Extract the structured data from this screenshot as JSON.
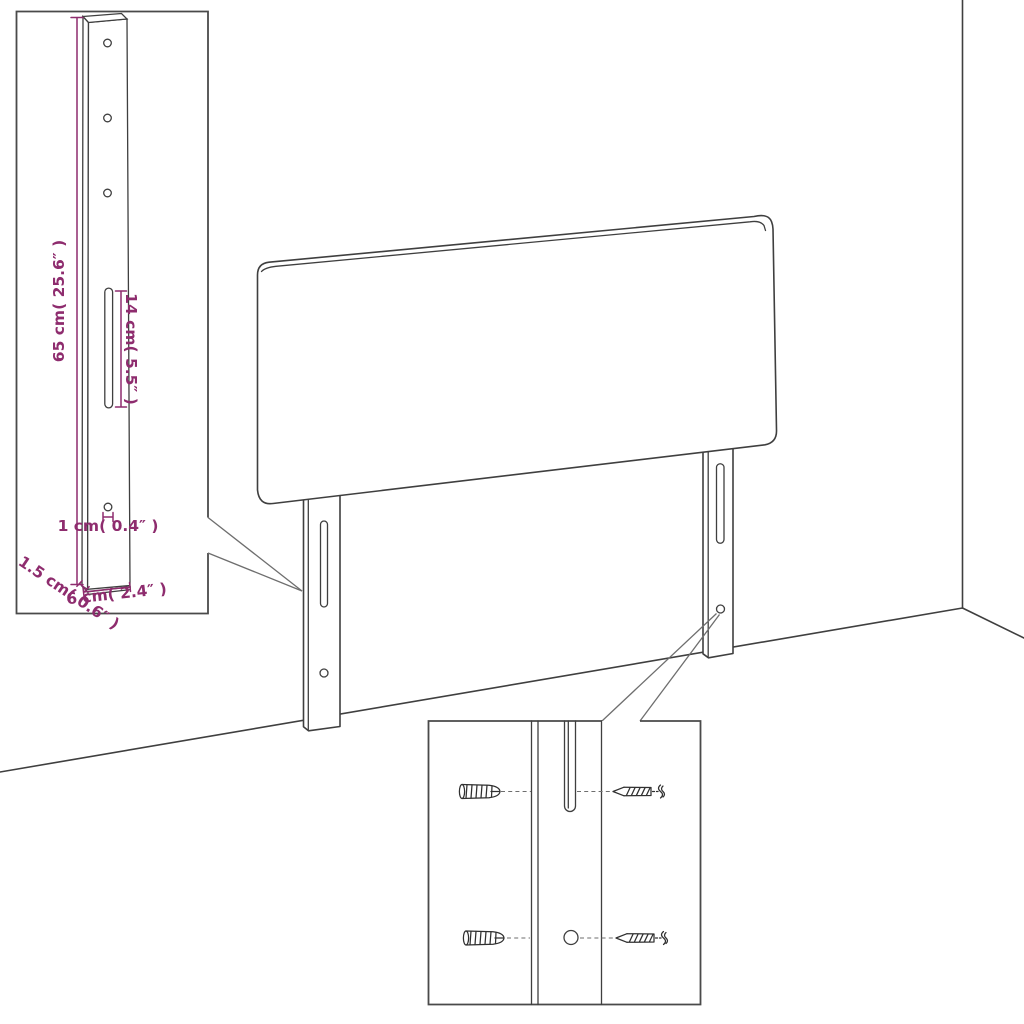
{
  "diagram": {
    "kind": "headboard-assembly-dimension-diagram",
    "labels": {
      "bracket_height": "65 cm( 25.6″ )",
      "slot_length": "14 cm( 5.5″ )",
      "hole_diameter": "1 cm( 0.4″ )",
      "bracket_depth": "1.5 cm( 0.6″ )",
      "bracket_width": "6 cm( 2.4″ )"
    },
    "colors": {
      "background": "#ffffff",
      "line": "#3f3f3f",
      "line_light": "#6e6e6e",
      "dimension": "#8e2c6e",
      "hardware": "#303030",
      "inset_border": "#4a4a4a"
    }
  }
}
